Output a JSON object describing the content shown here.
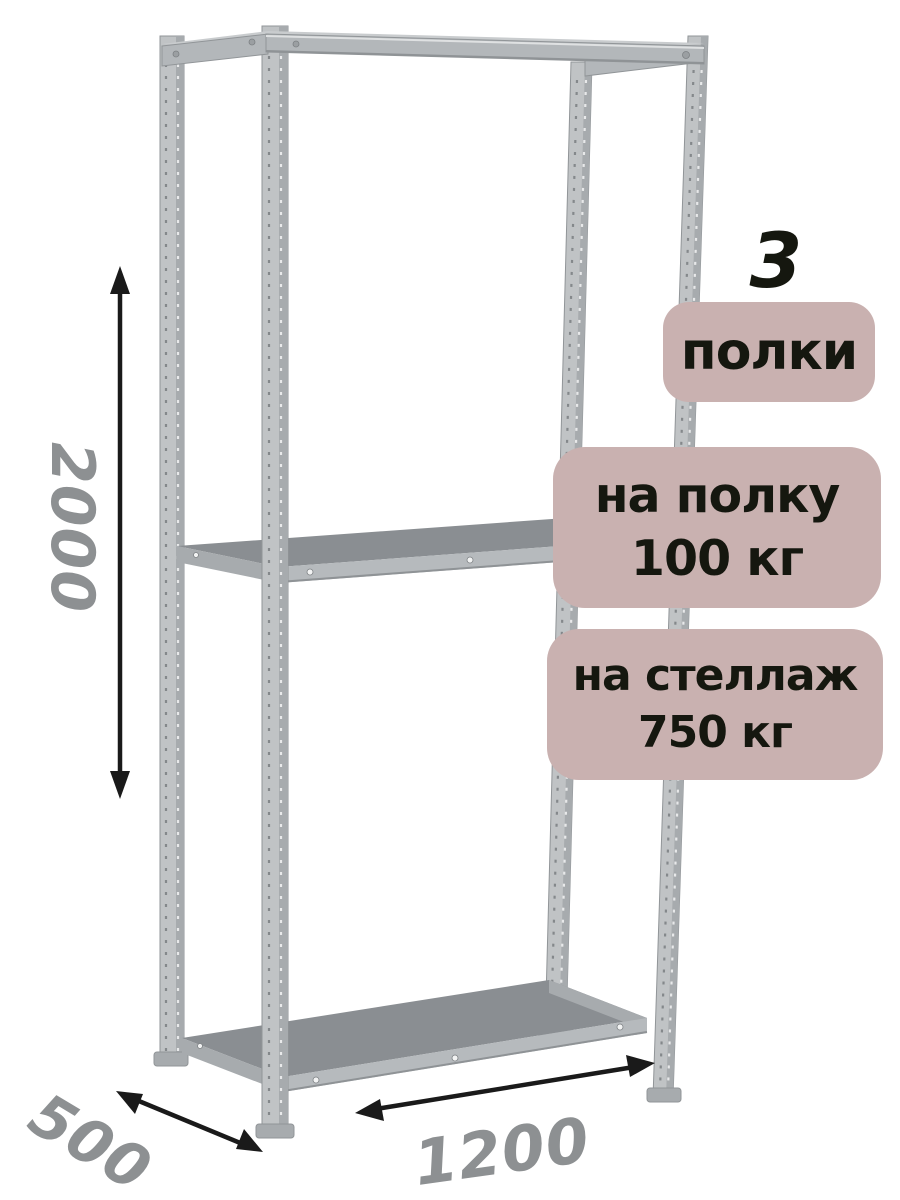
{
  "page": {
    "background": "#ffffff"
  },
  "colors": {
    "badge_bg": "#c9b1b0",
    "badge_text": "#15170f",
    "count_text": "#15170f",
    "dim_text": "#8d9092",
    "arrow": "#1a1a1a",
    "metal_light": "#c0c3c5",
    "metal_mid": "#a7abae",
    "metal_beam": "#b3b7ba",
    "metal_fascia": "#b6babd",
    "metal_dark": "#8a8e92",
    "metal_topsliver": "#c9ccce",
    "metal_edge": "#919598",
    "metal_hilite": "#dfe1e2",
    "metal_shade": "#8f9396",
    "metal_perf_dark": "#84888b",
    "metal_perf_light": "#e8e9ea"
  },
  "annotations": {
    "shelf_count": "3",
    "shelf_count_label": "полки",
    "per_shelf_load": {
      "line1": "на полку",
      "line2": "100 кг"
    },
    "per_rack_load": {
      "line1": "на стеллаж",
      "line2": "750 кг"
    },
    "dimensions": {
      "height": "2000",
      "depth": "500",
      "width": "1200"
    }
  }
}
